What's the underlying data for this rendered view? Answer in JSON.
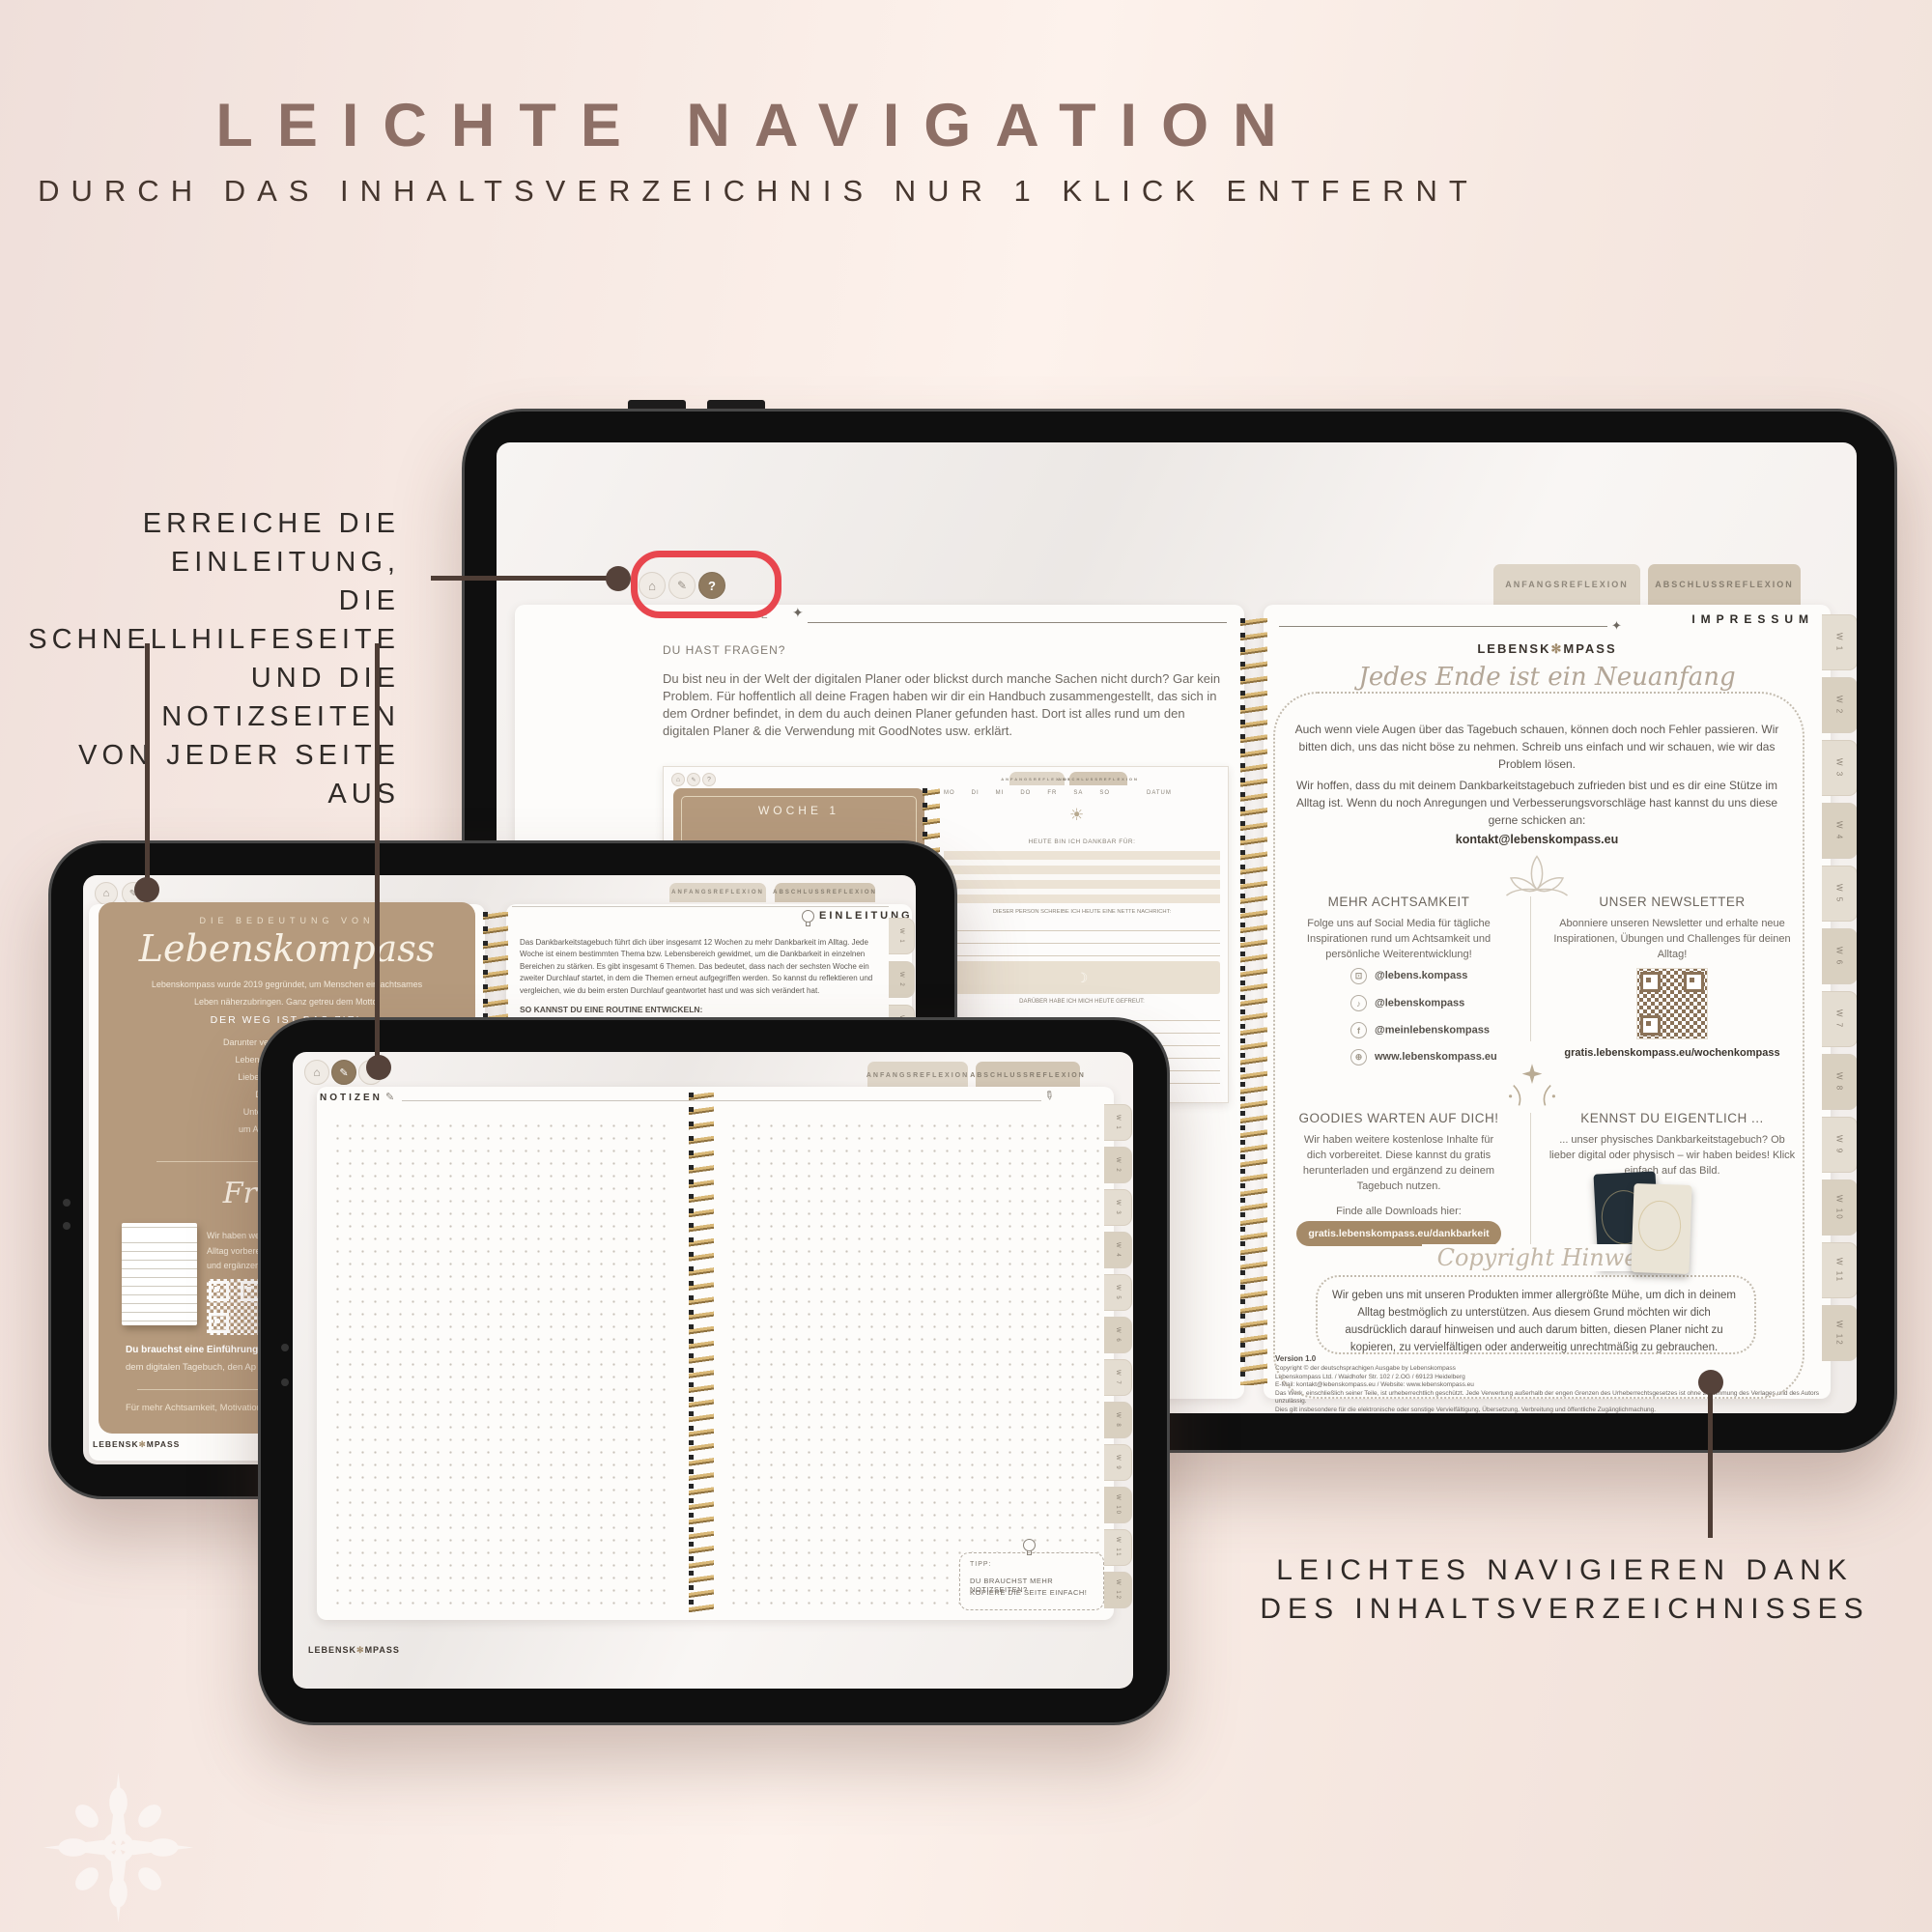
{
  "page": {
    "title": "LEICHTE NAVIGATION",
    "subtitle": "DURCH DAS INHALTSVERZEICHNIS NUR 1 KLICK ENTFERNT"
  },
  "annotations": {
    "left_lines": [
      "ERREICHE DIE EINLEITUNG,",
      "DIE SCHNELLHILFESEITE",
      "UND DIE NOTIZSEITEN",
      "VON JEDER SEITE AUS"
    ],
    "bottom_right_lines": [
      "LEICHTES NAVIGIEREN DANK",
      "DES INHALTSVERZEICHNISSES"
    ]
  },
  "colors": {
    "accent_red": "#e8464e",
    "connector_brown": "#4e3d35",
    "card_brown": "#b59a7d",
    "gold": "#c9a366",
    "title_mauve": "#8d6f66",
    "pill_brown": "#a58a68"
  },
  "icons": {
    "home": "⌂",
    "pen": "✎",
    "help": "?",
    "sparkle": "✦",
    "sun": "☀",
    "moon": "☽",
    "note": "♪",
    "f": "f",
    "insta": "⊡",
    "globe": "⊕",
    "flower": "✻"
  },
  "tabs": {
    "anfang": "ANFANGSREFLEXION",
    "abschluss": "ABSCHLUSSREFLEXION"
  },
  "week_tabs": [
    "W 1",
    "W 2",
    "W 3",
    "W 4",
    "W 5",
    "W 6",
    "W 7",
    "W 8",
    "W 9",
    "W 10",
    "W 11",
    "W 12"
  ],
  "logo": {
    "part1": "LEBENSK",
    "part2": "MPASS"
  },
  "large_tablet": {
    "left_page": {
      "title_strong": "SCHNELL",
      "title_light": "HILFE",
      "question": "DU HAST FRAGEN?",
      "paragraph": "Du bist neu in der Welt der digitalen Planer oder blickst durch manche Sachen nicht durch? Gar kein Problem. Für hoffentlich all deine Fragen haben wir dir ein Handbuch zusammengestellt, das sich in dem Ordner befindet, in dem du auch deinen Planer gefunden hast. Dort ist alles rund um den digitalen Planer & die Verwendung mit GoodNotes usw. erklärt.",
      "mini": {
        "woche": "WOCHE 1",
        "days": [
          "MO",
          "DI",
          "MI",
          "DO",
          "FR",
          "SA",
          "SO"
        ],
        "datum": "DATUM",
        "dankbar": "HEUTE BIN ICH DANKBAR FÜR:",
        "person": "DIESER PERSON SCHREIBE ICH HEUTE EINE NETTE NACHRICHT:",
        "gefreut": "DARÜBER HABE ICH MICH HEUTE GEFREUT:"
      }
    },
    "right_page": {
      "heading": "IMPRESSUM",
      "script_title": "Jedes Ende ist ein Neuanfang",
      "para1": "Auch wenn viele Augen über das Tagebuch schauen, können doch noch Fehler passieren. Wir bitten dich, uns das nicht böse zu nehmen. Schreib uns einfach und wir schauen, wie wir das Problem lösen.",
      "para2": "Wir hoffen, dass du mit deinem Dankbarkeitstagebuch zufrieden bist und es dir eine Stütze im Alltag ist. Wenn du noch Anregungen und Verbesserungsvorschläge hast kannst du uns diese gerne schicken an:",
      "email": "kontakt@lebenskompass.eu",
      "col_social": {
        "heading": "MEHR ACHTSAMKEIT",
        "text": "Folge uns auf Social Media für tägliche Inspirationen rund um Achtsamkeit und persönliche Weiterentwicklung!",
        "links": [
          {
            "icon": "instagram-icon",
            "label": "@lebens.kompass"
          },
          {
            "icon": "tiktok-icon",
            "label": "@lebenskompass"
          },
          {
            "icon": "facebook-icon",
            "label": "@meinlebenskompass"
          },
          {
            "icon": "globe-icon",
            "label": "www.lebenskompass.eu"
          }
        ]
      },
      "col_news": {
        "heading": "UNSER NEWSLETTER",
        "text": "Abonniere unseren Newsletter und erhalte neue Inspirationen, Übungen und Challenges für deinen Alltag!",
        "link": "gratis.lebenskompass.eu/wochenkompass"
      },
      "col_goodies": {
        "heading": "GOODIES WARTEN AUF DICH!",
        "text": "Wir haben weitere kostenlose Inhalte für dich vorbereitet. Diese kannst du gratis herunterladen und ergänzend zu deinem Tagebuch nutzen.",
        "find": "Finde alle Downloads hier:",
        "pill": "gratis.lebenskompass.eu/dankbarkeit"
      },
      "col_physical": {
        "heading": "KENNST DU EIGENTLICH ...",
        "text": "... unser physisches Dankbarkeitstagebuch? Ob lieber digital oder physisch – wir haben beides! Klick einfach auf das Bild."
      },
      "copyright": {
        "script_title": "Copyright Hinweis",
        "text": "Wir geben uns mit unseren Produkten immer allergrößte Mühe, um dich in deinem Alltag bestmöglich zu unterstützen. Aus diesem Grund möchten wir dich ausdrücklich darauf hinweisen und auch darum bitten, diesen Planer nicht zu kopieren, zu vervielfältigen oder anderweitig unrechtmäßig zu gebrauchen."
      },
      "version": "Version 1.0",
      "fine_print": [
        "Copyright © der deutschsprachigen Ausgabe by Lebenskompass",
        "Lebenskompass Ltd. / Waidhofer Str. 102 / 2.OG / 69123 Heidelberg",
        "E-Mail: kontakt@lebenskompass.eu / Website: www.lebenskompass.eu",
        "Das Werk, einschließlich seiner Teile, ist urheberrechtlich geschützt. Jede Verwertung außerhalb der engen Grenzen des Urheberrechtsgesetzes ist ohne Zustimmung des Verlages und des Autors unzulässig.",
        "Dies gilt insbesondere für die elektronische oder sonstige Vervielfältigung, Übersetzung, Verbreitung und öffentliche Zugänglichmachung."
      ]
    }
  },
  "left_tablet": {
    "brown_page": {
      "eyebrow": "DIE BEDEUTUNG VON",
      "script_title": "Lebenskompass",
      "line1": "Lebenskompass wurde 2019 gegründet, um Menschen ein achtsames",
      "line2": "Leben näherzubringen. Ganz getreu dem Motto:",
      "motto": "DER WEG IST DAS ZIEL",
      "more_lines": [
        "Darunter verstehen wir, dass Ach",
        "Leben zu führen. Ein bewu",
        "Liebe zu uns selbst und z",
        "Dankbarkeit und",
        "Unter diesen Aspekten",
        "um Achtsamkeit im Alltag"
      ],
      "freebies_title": "Freebies",
      "freebies_lines": [
        "Wir haben we",
        "Alltag vorbere",
        "und ergänzen"
      ],
      "bold_line": "Du brauchst eine Einführung?",
      "bold_line2": "dem digitalen Tagebuch, den Ap",
      "footer": "Für mehr Achtsamkeit, Motivation"
    },
    "intro_page": {
      "heading": "EINLEITUNG",
      "paragraph": "Das Dankbarkeitstagebuch führt dich über insgesamt 12 Wochen zu mehr Dankbarkeit im Alltag. Jede Woche ist einem bestimmten Thema bzw. Lebensbereich gewidmet, um die Dankbarkeit in einzelnen Bereichen zu stärken. Es gibt insgesamt 6 Themen. Das bedeutet, dass nach der sechsten Woche ein zweiter Durchlauf startet, in dem die Themen erneut aufgegriffen werden. So kannst du reflektieren und vergleichen, wie du beim ersten Durchlauf geantwortet hast und was sich verändert hat.",
      "routine": "SO KANNST DU EINE ROUTINE ENTWICKELN:"
    }
  },
  "center_tablet": {
    "heading": "NOTIZEN",
    "tipp": {
      "label": "TIPP:",
      "line1": "DU BRAUCHST MEHR NOTIZSEITEN?",
      "line2": "KOPIERE DIE SEITE EINFACH!"
    }
  }
}
